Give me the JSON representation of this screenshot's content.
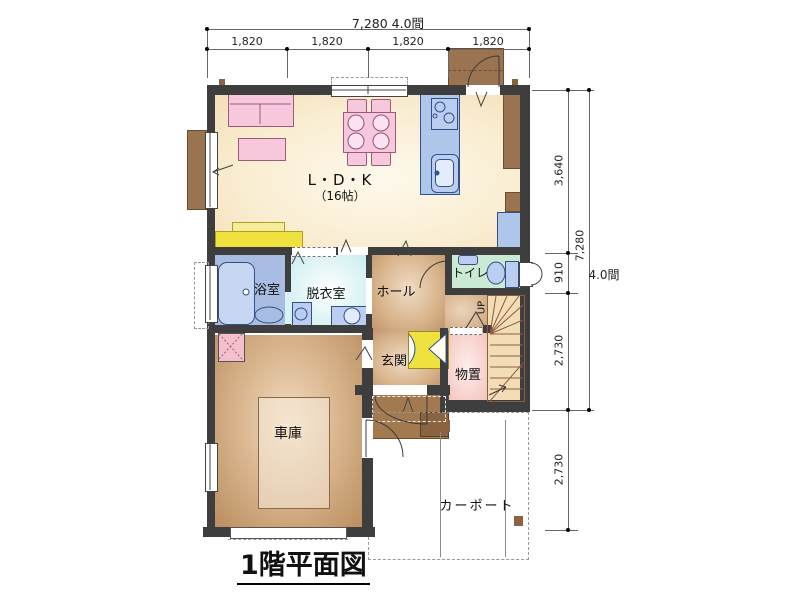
{
  "plan": {
    "title": "1階平面図",
    "dimensions": {
      "top_total": "7,280 4.0間",
      "top_segments": [
        "1,820",
        "1,820",
        "1,820",
        "1,820"
      ],
      "right_upper": "3,640",
      "right_mid": "910",
      "right_lower1": "2,730",
      "right_lower2": "2,730",
      "right_total": "7,280",
      "right_total_ken": "4.0間"
    },
    "rooms": {
      "ldk": "L・D・K",
      "ldk_size": "（16帖）",
      "bath": "浴室",
      "dressing": "脱衣室",
      "hall": "ホール",
      "toilet": "トイレ",
      "entrance": "玄関",
      "storage": "物置",
      "garage": "車庫",
      "carport": "カーポート",
      "stairs": "UP"
    },
    "colors": {
      "wall": "#3E3E3E",
      "ldk_floor": "#F8ECD0",
      "wood_floor": "#C59A6F",
      "furniture_pink": "#F7C8DC",
      "fixture_blue": "#BBCDF0",
      "kitchen_blue": "#AFC7EB",
      "bath_floor": "#A9BDE3",
      "dressing_floor": "#D5F1F3",
      "toilet_floor": "#CBEAD3",
      "storage_floor": "#F5C9C4",
      "stairs_floor": "#F3DDB6",
      "cabinet_yellow": "#EFE23E",
      "door_brown": "#9A7450"
    }
  }
}
